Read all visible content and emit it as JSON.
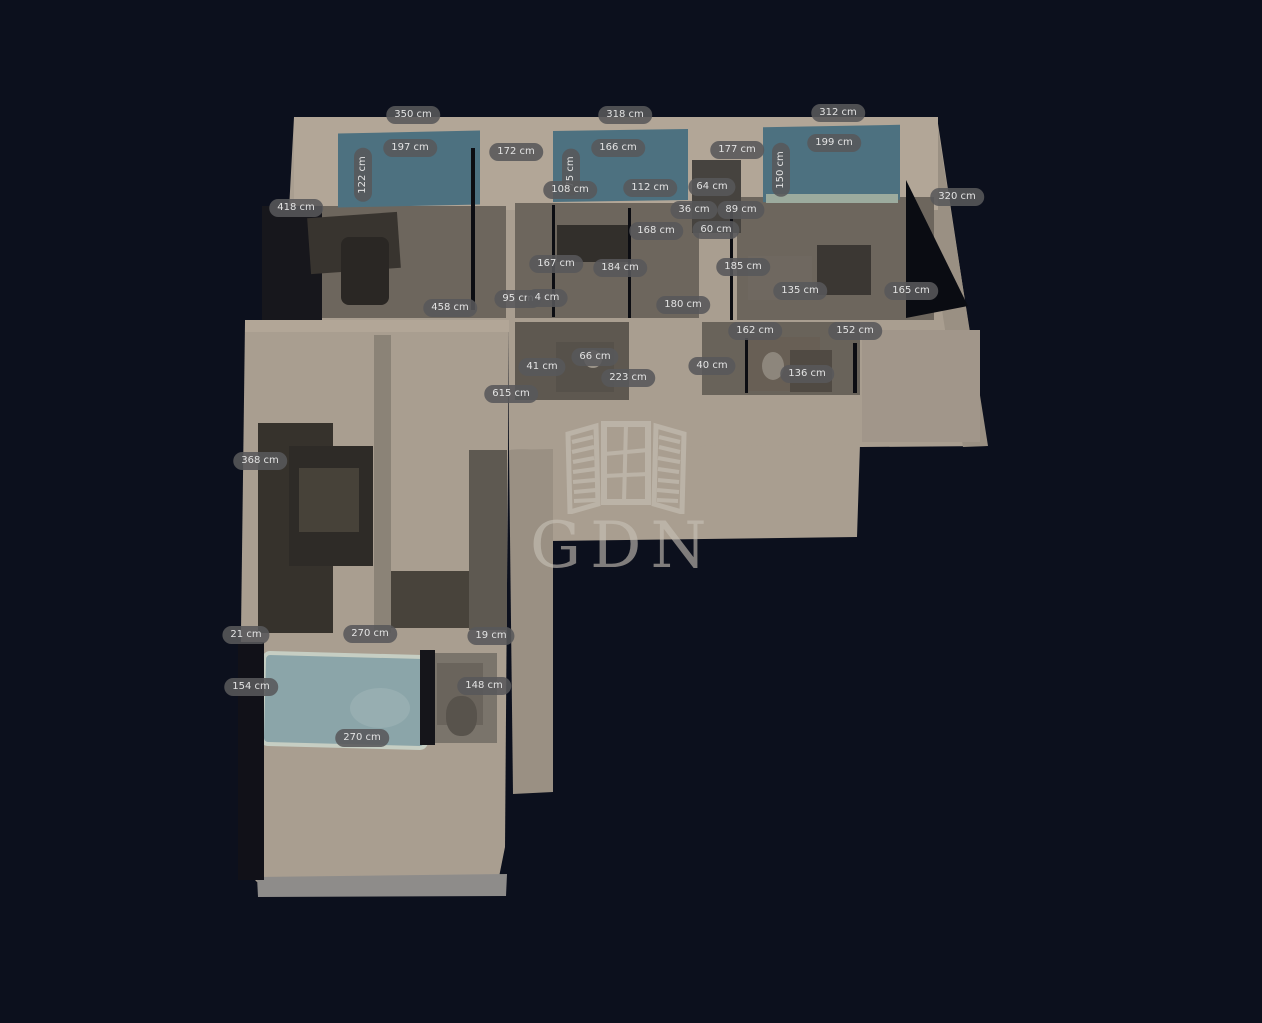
{
  "watermark": {
    "text": "GDN",
    "icon": "window-shutters-icon"
  },
  "units": "cm",
  "colors": {
    "background": "#0c101d",
    "wall": "#a99e90",
    "wallLight": "#b2a697",
    "wallDark": "#9a9083",
    "floorGray": "#6d665d",
    "window": "#4d7180",
    "labelBg": "#58585a",
    "watermark": "#c7c1b6",
    "bathtub": "#8ba5a9",
    "furnitureDark": "#38342f"
  },
  "labels": [
    {
      "text": "350 cm",
      "x": 413,
      "y": 115
    },
    {
      "text": "318 cm",
      "x": 625,
      "y": 115
    },
    {
      "text": "312 cm",
      "x": 838,
      "y": 113
    },
    {
      "text": "197 cm",
      "x": 410,
      "y": 148
    },
    {
      "text": "172 cm",
      "x": 516,
      "y": 152
    },
    {
      "text": "166 cm",
      "x": 618,
      "y": 148
    },
    {
      "text": "177 cm",
      "x": 737,
      "y": 150
    },
    {
      "text": "199 cm",
      "x": 834,
      "y": 143
    },
    {
      "text": "320 cm",
      "x": 957,
      "y": 197
    },
    {
      "text": "418 cm",
      "x": 296,
      "y": 208
    },
    {
      "text": "122 cm",
      "x": 363,
      "y": 175,
      "rot": true
    },
    {
      "text": "75 cm",
      "x": 571,
      "y": 172,
      "rot": true
    },
    {
      "text": "150 cm",
      "x": 781,
      "y": 170,
      "rot": true
    },
    {
      "text": "108 cm",
      "x": 570,
      "y": 190
    },
    {
      "text": "112 cm",
      "x": 650,
      "y": 188
    },
    {
      "text": "64 cm",
      "x": 712,
      "y": 187
    },
    {
      "text": "36 cm",
      "x": 694,
      "y": 210
    },
    {
      "text": "89 cm",
      "x": 741,
      "y": 210
    },
    {
      "text": "168 cm",
      "x": 656,
      "y": 231
    },
    {
      "text": "60 cm",
      "x": 716,
      "y": 230
    },
    {
      "text": "167 cm",
      "x": 556,
      "y": 264
    },
    {
      "text": "184 cm",
      "x": 620,
      "y": 268
    },
    {
      "text": "185 cm",
      "x": 743,
      "y": 267
    },
    {
      "text": "135 cm",
      "x": 800,
      "y": 291
    },
    {
      "text": "165 cm",
      "x": 911,
      "y": 291
    },
    {
      "text": "458 cm",
      "x": 450,
      "y": 308
    },
    {
      "text": "95 cm",
      "x": 518,
      "y": 299
    },
    {
      "text": "4 cm",
      "x": 547,
      "y": 298
    },
    {
      "text": "180 cm",
      "x": 683,
      "y": 305
    },
    {
      "text": "162 cm",
      "x": 755,
      "y": 331
    },
    {
      "text": "152 cm",
      "x": 855,
      "y": 331
    },
    {
      "text": "66 cm",
      "x": 595,
      "y": 357
    },
    {
      "text": "41 cm",
      "x": 542,
      "y": 367
    },
    {
      "text": "223 cm",
      "x": 628,
      "y": 378
    },
    {
      "text": "40 cm",
      "x": 712,
      "y": 366
    },
    {
      "text": "136 cm",
      "x": 807,
      "y": 374
    },
    {
      "text": "615 cm",
      "x": 511,
      "y": 394
    },
    {
      "text": "368 cm",
      "x": 260,
      "y": 461
    },
    {
      "text": "21 cm",
      "x": 246,
      "y": 635
    },
    {
      "text": "270 cm",
      "x": 370,
      "y": 634
    },
    {
      "text": "19 cm",
      "x": 491,
      "y": 636
    },
    {
      "text": "154 cm",
      "x": 251,
      "y": 687
    },
    {
      "text": "148 cm",
      "x": 484,
      "y": 686
    },
    {
      "text": "270 cm",
      "x": 362,
      "y": 738
    }
  ]
}
